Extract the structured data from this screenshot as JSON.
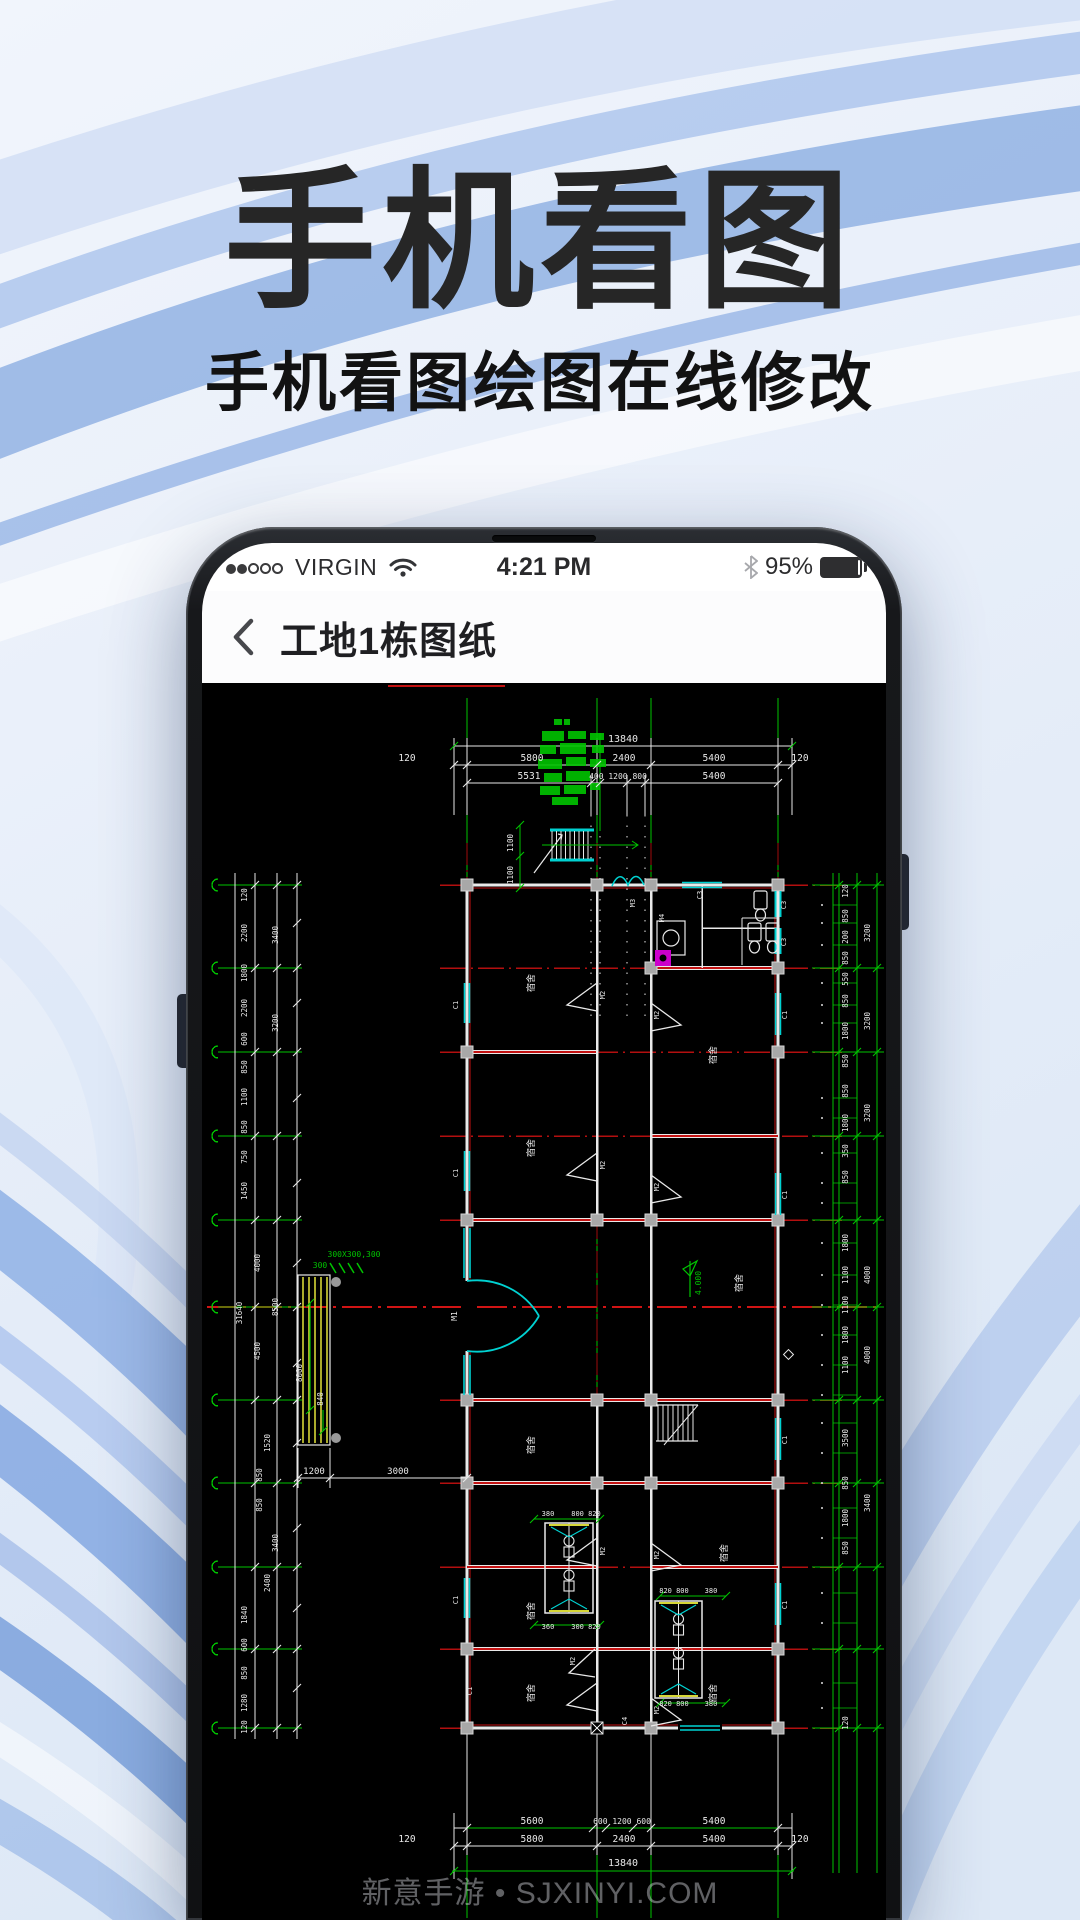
{
  "hero": {
    "title": "手机看图",
    "subtitle": "手机看图绘图在线修改"
  },
  "watermark": "新意手游 • SJXINYI.COM",
  "phone": {
    "status_bar": {
      "carrier": "VIRGIN",
      "time": "4:21 PM",
      "battery_percent": "95%",
      "signal_filled": 2,
      "signal_total": 5
    },
    "nav": {
      "title": "工地1栋图纸"
    }
  },
  "cad": {
    "colors": {
      "green": "#00c400",
      "red": "#c31111",
      "cyan": "#00d2d2",
      "yellow": "#d6d636",
      "line_white": "#e9e9e9",
      "column_gray": "#a8a8a8",
      "magenta": "#cc00cc"
    },
    "dims_top": {
      "total": "13840",
      "row2": [
        "120",
        "5800",
        "2400",
        "5400",
        "120"
      ],
      "row3": [
        "5531",
        "400 1200 800",
        "5400"
      ]
    },
    "dims_bottom": {
      "row1": [
        "5600",
        "600 1200 600",
        "5400"
      ],
      "row2": [
        "120",
        "5800",
        "2400",
        "5400",
        "120"
      ],
      "total": "13840"
    },
    "dims_left": [
      "120",
      "2200",
      "3400",
      "1800",
      "2200",
      "600",
      "850",
      "1100",
      "850",
      "3200",
      "750",
      "1450",
      "31640",
      "4000",
      "8500",
      "4500",
      "8000",
      "840",
      "1520",
      "850",
      "850",
      "3400",
      "2400",
      "1840",
      "600",
      "850",
      "1280",
      "120"
    ],
    "dims_right": [
      "120",
      "3200",
      "850",
      "200",
      "850",
      "550",
      "850",
      "1800",
      "850",
      "3200",
      "850",
      "1800",
      "350",
      "850",
      "3200",
      "1800",
      "1100",
      "1100",
      "4000",
      "1800",
      "1100",
      "4000",
      "3500",
      "850",
      "1800",
      "3400",
      "850",
      "120"
    ],
    "dims_ramp": [
      "1200",
      "3000"
    ],
    "dims_stair": [
      "1100",
      "1100"
    ],
    "ramp_notes": [
      "300X300,300",
      "300"
    ],
    "bath_dims": [
      "380",
      "800 820",
      "360",
      "300 820",
      "820 800",
      "380",
      "820 800",
      "380"
    ],
    "labels": {
      "door_main": "M1",
      "door_room": "M2",
      "door_bath": "M3",
      "door_m4": "M4",
      "window_c1": "C1",
      "window_c3": "C3",
      "window_c4": "C4",
      "room": "宿舍",
      "elevation": "4.000"
    }
  }
}
